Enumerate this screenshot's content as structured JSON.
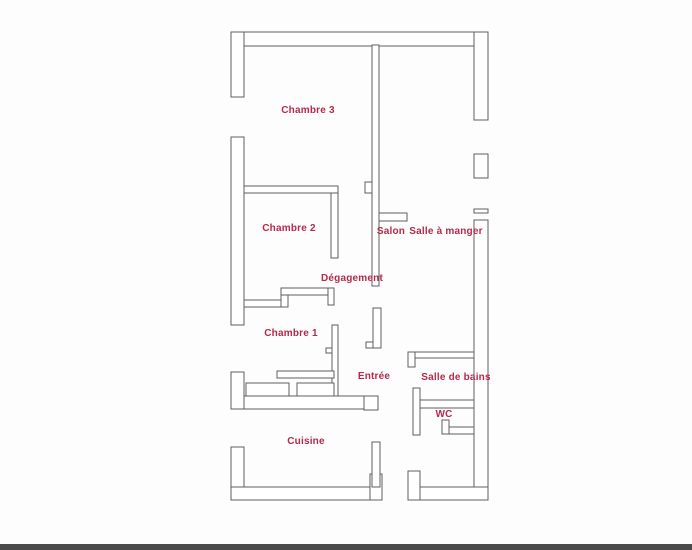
{
  "plan": {
    "width": 692,
    "height": 550,
    "colors": {
      "background": "#fdfdfd",
      "wall_stroke": "#5f5f5f",
      "wall_fill": "#ffffff",
      "label": "#b5294a",
      "scan_strip": "#4a4a4a"
    },
    "rooms": [
      {
        "name": "Chambre 3",
        "x": 308,
        "y": 113
      },
      {
        "name": "Chambre 2",
        "x": 289,
        "y": 231
      },
      {
        "name": "Salon",
        "x": 391,
        "y": 234
      },
      {
        "name": "Salle à manger",
        "x": 446,
        "y": 234
      },
      {
        "name": "Dégagement",
        "x": 352,
        "y": 281
      },
      {
        "name": "Chambre 1",
        "x": 291,
        "y": 336
      },
      {
        "name": "Entrée",
        "x": 374,
        "y": 379
      },
      {
        "name": "Salle de bains",
        "x": 456,
        "y": 380
      },
      {
        "name": "WC",
        "x": 444,
        "y": 417
      },
      {
        "name": "Cuisine",
        "x": 306,
        "y": 444
      }
    ],
    "walls": [
      {
        "id": "top-wall",
        "x": 231,
        "y": 32,
        "w": 257,
        "h": 14
      },
      {
        "id": "right-wall-upper",
        "x": 474,
        "y": 32,
        "w": 14,
        "h": 88
      },
      {
        "id": "right-window",
        "x": 474,
        "y": 154,
        "w": 14,
        "h": 24
      },
      {
        "id": "right-sill",
        "x": 474,
        "y": 209,
        "w": 14,
        "h": 4
      },
      {
        "id": "right-wall-lower",
        "x": 474,
        "y": 220,
        "w": 14,
        "h": 280
      },
      {
        "id": "left-wall-1",
        "x": 231,
        "y": 32,
        "w": 13,
        "h": 65
      },
      {
        "id": "left-wall-2",
        "x": 231,
        "y": 137,
        "w": 13,
        "h": 188
      },
      {
        "id": "left-wall-3",
        "x": 231,
        "y": 372,
        "w": 13,
        "h": 37
      },
      {
        "id": "left-wall-4",
        "x": 231,
        "y": 447,
        "w": 13,
        "h": 53
      },
      {
        "id": "bottom-wall-left",
        "x": 231,
        "y": 487,
        "w": 151,
        "h": 13
      },
      {
        "id": "bottom-wall-left-jamb",
        "x": 370,
        "y": 474,
        "w": 12,
        "h": 26
      },
      {
        "id": "bottom-wall-right",
        "x": 408,
        "y": 487,
        "w": 80,
        "h": 13
      },
      {
        "id": "bottom-wall-right-jamb",
        "x": 408,
        "y": 471,
        "w": 12,
        "h": 29
      },
      {
        "id": "chambre2-top-wall",
        "x": 244,
        "y": 186,
        "w": 94,
        "h": 7
      },
      {
        "id": "chambre2-right-wall",
        "x": 331,
        "y": 193,
        "w": 7,
        "h": 65
      },
      {
        "id": "salon-wall",
        "x": 372,
        "y": 45,
        "w": 7,
        "h": 241
      },
      {
        "id": "salon-door-tab",
        "x": 365,
        "y": 182,
        "w": 7,
        "h": 11
      },
      {
        "id": "salon-stub-wall",
        "x": 379,
        "y": 213,
        "w": 28,
        "h": 8
      },
      {
        "id": "entree-left-wall",
        "x": 373,
        "y": 308,
        "w": 8,
        "h": 40
      },
      {
        "id": "entree-left-hook",
        "x": 366,
        "y": 342,
        "w": 7,
        "h": 6
      },
      {
        "id": "corridor-wall-low",
        "x": 244,
        "y": 300,
        "w": 44,
        "h": 7
      },
      {
        "id": "corridor-step",
        "x": 281,
        "y": 288,
        "w": 7,
        "h": 19
      },
      {
        "id": "corridor-wall-high",
        "x": 281,
        "y": 288,
        "w": 52,
        "h": 7
      },
      {
        "id": "corridor-endcap",
        "x": 328,
        "y": 288,
        "w": 6,
        "h": 17
      },
      {
        "id": "chambre1-right-wall",
        "x": 332,
        "y": 325,
        "w": 6,
        "h": 72
      },
      {
        "id": "chambre1-door-tab",
        "x": 326,
        "y": 348,
        "w": 6,
        "h": 5
      },
      {
        "id": "closet-top-wall",
        "x": 277,
        "y": 371,
        "w": 57,
        "h": 7
      },
      {
        "id": "closet-box-1",
        "x": 246,
        "y": 383,
        "w": 43,
        "h": 14
      },
      {
        "id": "closet-box-2",
        "x": 297,
        "y": 383,
        "w": 37,
        "h": 14
      },
      {
        "id": "chambre1-bottom-wall",
        "x": 244,
        "y": 396,
        "w": 128,
        "h": 13
      },
      {
        "id": "chambre1-bottom-jamb",
        "x": 364,
        "y": 396,
        "w": 14,
        "h": 14
      },
      {
        "id": "bath-top-wall",
        "x": 408,
        "y": 352,
        "w": 66,
        "h": 6
      },
      {
        "id": "bath-top-hook",
        "x": 408,
        "y": 352,
        "w": 7,
        "h": 15
      },
      {
        "id": "wc-left-wall",
        "x": 413,
        "y": 388,
        "w": 7,
        "h": 47
      },
      {
        "id": "wc-top-wall",
        "x": 420,
        "y": 400,
        "w": 54,
        "h": 8
      },
      {
        "id": "wc-bottom-wall",
        "x": 442,
        "y": 427,
        "w": 32,
        "h": 7
      },
      {
        "id": "wc-bottom-hook",
        "x": 442,
        "y": 420,
        "w": 7,
        "h": 14
      },
      {
        "id": "cuisine-right-wall",
        "x": 372,
        "y": 442,
        "w": 8,
        "h": 45
      }
    ],
    "scan_strip": {
      "x": 0,
      "y": 544,
      "w": 692,
      "h": 6
    }
  }
}
